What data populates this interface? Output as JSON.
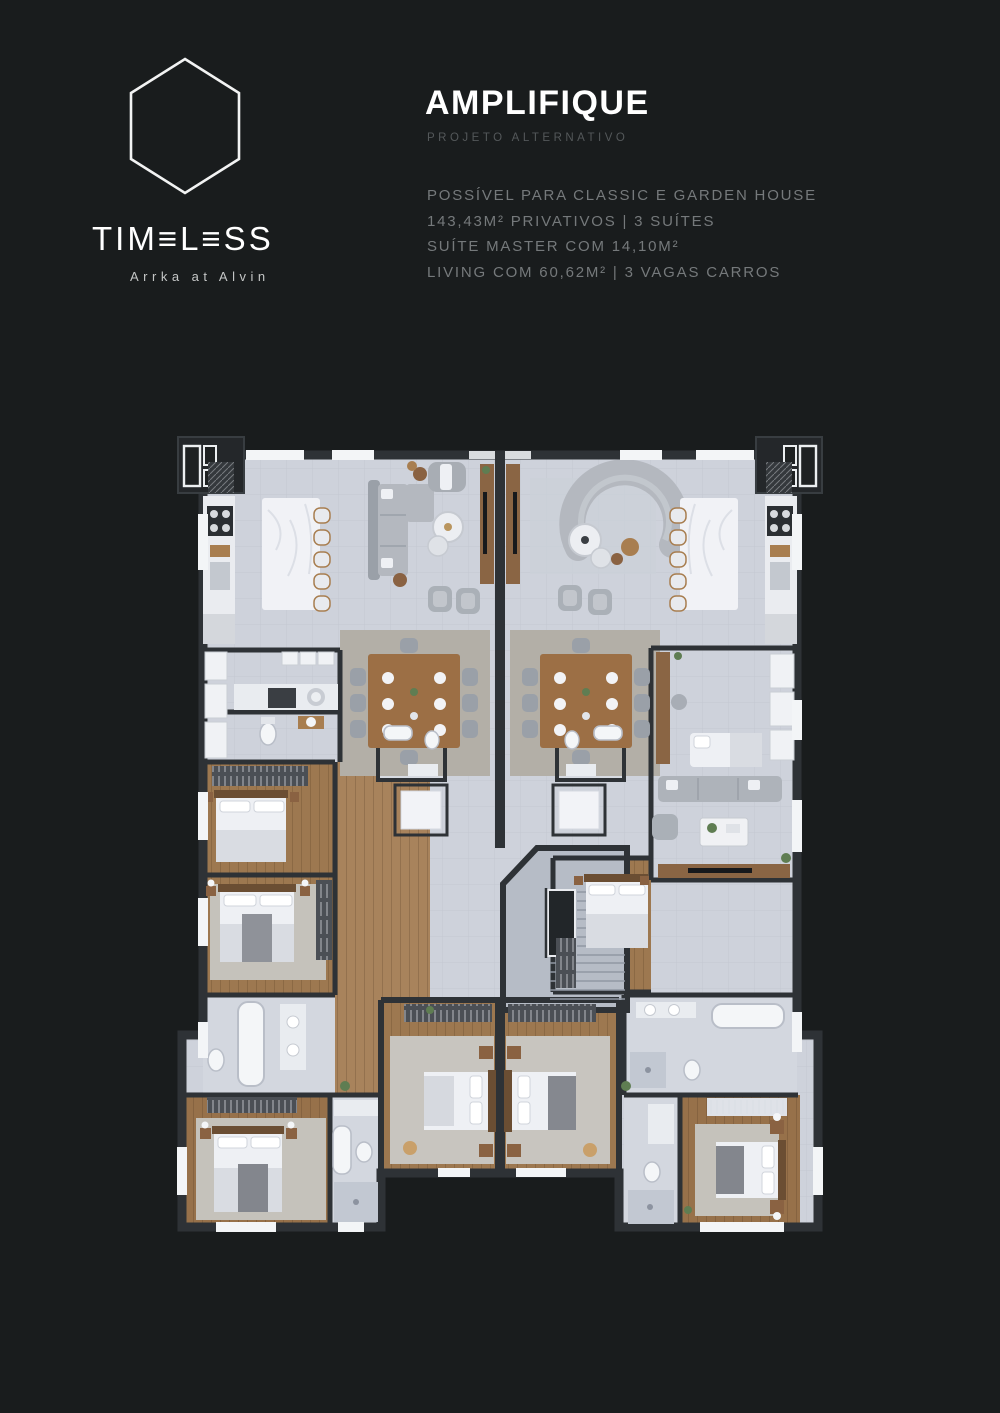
{
  "colors": {
    "background": "#191c1d",
    "title_text": "#ffffff",
    "subtitle_text": "#54585a",
    "specs_text": "#75797b",
    "tagline_text": "#c4c6c6",
    "plan_floor": "#ced2db",
    "plan_wood": "#9d7850",
    "plan_wall": "#2e3236",
    "plan_rug": "#b3afa7",
    "plan_white": "#eef0f4"
  },
  "brand": {
    "logo_icon": "hexagon-outline",
    "wordmark": "TIMELESS",
    "wordmark_display": "TIM≡L≡SS",
    "tagline": "Arrka at Alvin"
  },
  "header": {
    "title": "AMPLIFIQUE",
    "subtitle": "PROJETO ALTERNATIVO"
  },
  "specs": {
    "lines": [
      "POSSÍVEL PARA CLASSIC E GARDEN HOUSE",
      "143,43M² PRIVATIVOS | 3 SUÍTES",
      "SUÍTE MASTER COM 14,10M²",
      "LIVING COM 60,62M² | 3 VAGAS CARROS"
    ]
  },
  "floorplan": {
    "kind": "top-down architectural render",
    "units": "two mirrored apartment units with central stair core",
    "rooms": [
      "kitchen",
      "living",
      "dining",
      "service",
      "lavabo",
      "suites",
      "master suite",
      "bathrooms",
      "stair core"
    ]
  }
}
